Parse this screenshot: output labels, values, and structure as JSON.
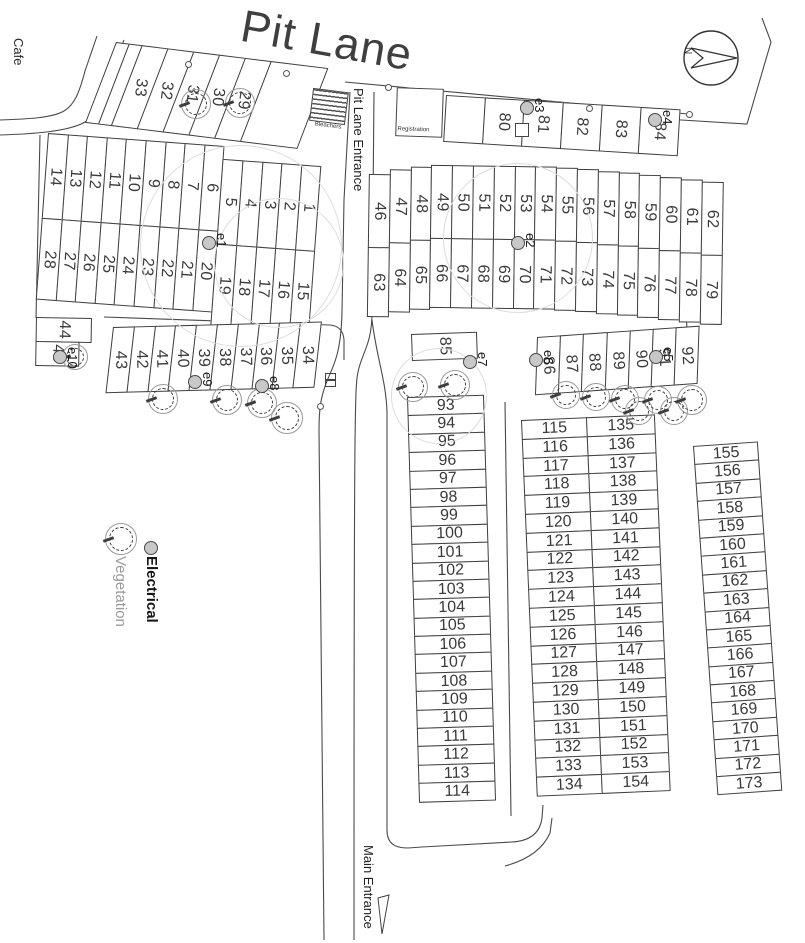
{
  "title": "Pit Lane",
  "compass": {
    "north_label": "N"
  },
  "labels": {
    "cafe": "Cafe",
    "pit_lane_entrance": "Pit Lane Entrance",
    "main_entrance": "Main Entrance",
    "bleachers": "Bleachers",
    "registration": "Registration"
  },
  "legend": {
    "electrical": "Electrical",
    "vegetation": "Vegetation"
  },
  "colors": {
    "line": "#3e3e3e",
    "faint_circle": "#dddddd",
    "electrical_fill": "#c8c8c8",
    "vegetation_stroke": "#9a9a9a",
    "title_text": "#3f3f3f"
  },
  "blocks": {
    "strip_nw": [
      "",
      "",
      "33",
      "32",
      "31",
      "30",
      "29",
      ""
    ],
    "rows_nw": {
      "columns": [
        {
          "t": "14",
          "b": "28"
        },
        {
          "t": "13",
          "b": "27"
        },
        {
          "t": "12",
          "b": "26"
        },
        {
          "t": "11",
          "b": "25"
        },
        {
          "t": "10",
          "b": "24"
        },
        {
          "t": "9",
          "b": "23"
        },
        {
          "t": "8",
          "b": "22"
        },
        {
          "t": "7",
          "b": "21"
        },
        {
          "t": "6",
          "b": "20"
        },
        {
          "t": "5",
          "b": "19",
          "dy": 13
        },
        {
          "t": "4",
          "b": "18",
          "dy": 13
        },
        {
          "t": "3",
          "b": "17",
          "dy": 13
        },
        {
          "t": "2",
          "b": "16",
          "dy": 13
        },
        {
          "t": "1",
          "b": "15",
          "dy": 13
        }
      ]
    },
    "strip_n": [
      "",
      "80",
      "81",
      "82",
      "83",
      "84"
    ],
    "rows_mid": {
      "columns": [
        {
          "t": "46",
          "b": "63",
          "dy": 10
        },
        {
          "t": "47",
          "b": "64",
          "dy": 5
        },
        {
          "t": "48",
          "b": "65",
          "dy": 2
        },
        {
          "t": "49",
          "b": "66"
        },
        {
          "t": "50",
          "b": "67"
        },
        {
          "t": "51",
          "b": "68"
        },
        {
          "t": "52",
          "b": "69"
        },
        {
          "t": "53",
          "b": "70"
        },
        {
          "t": "54",
          "b": "71"
        },
        {
          "t": "55",
          "b": "72",
          "dy": 1
        },
        {
          "t": "56",
          "b": "73",
          "dy": 2
        },
        {
          "t": "57",
          "b": "74",
          "dy": 4
        },
        {
          "t": "58",
          "b": "75",
          "dy": 5
        },
        {
          "t": "59",
          "b": "76",
          "dy": 7
        },
        {
          "t": "60",
          "b": "77",
          "dy": 9
        },
        {
          "t": "61",
          "b": "78",
          "dy": 11
        },
        {
          "t": "62",
          "b": "79",
          "dy": 13
        }
      ]
    },
    "pair_w": [
      "44",
      "45"
    ],
    "row_w": [
      "43",
      "42",
      "41",
      "40",
      "39",
      "38",
      "37",
      "36",
      "35",
      "34"
    ],
    "s85": "85",
    "row_e": [
      "86",
      "87",
      "88",
      "89",
      "90",
      "91",
      "92"
    ],
    "col_a": [
      "93",
      "94",
      "95",
      "96",
      "97",
      "98",
      "99",
      "100",
      "101",
      "102",
      "103",
      "104",
      "105",
      "106",
      "107",
      "108",
      "109",
      "110",
      "111",
      "112",
      "113",
      "114"
    ],
    "col_b": [
      "115",
      "116",
      "117",
      "118",
      "119",
      "120",
      "121",
      "122",
      "123",
      "124",
      "125",
      "126",
      "127",
      "128",
      "129",
      "130",
      "131",
      "132",
      "133",
      "134"
    ],
    "col_c": [
      "135",
      "136",
      "137",
      "138",
      "139",
      "140",
      "141",
      "142",
      "143",
      "144",
      "145",
      "146",
      "147",
      "148",
      "149",
      "150",
      "151",
      "152",
      "153",
      "154"
    ],
    "col_d": [
      "155",
      "156",
      "157",
      "158",
      "159",
      "160",
      "161",
      "162",
      "163",
      "164",
      "165",
      "166",
      "167",
      "168",
      "169",
      "170",
      "171",
      "172",
      "173"
    ]
  },
  "markers": {
    "electrical": [
      {
        "x": 209,
        "y": 243,
        "r": 7,
        "label": "e1"
      },
      {
        "x": 518,
        "y": 243,
        "r": 7,
        "label": "e2"
      },
      {
        "x": 527,
        "y": 108,
        "r": 7,
        "label": "e3"
      },
      {
        "x": 655,
        "y": 120,
        "r": 7,
        "label": "e4"
      },
      {
        "x": 656,
        "y": 357,
        "r": 7,
        "label": "e5"
      },
      {
        "x": 536,
        "y": 360,
        "r": 7,
        "label": "e6"
      },
      {
        "x": 470,
        "y": 362,
        "r": 7,
        "label": "e7"
      },
      {
        "x": 262,
        "y": 386,
        "r": 7,
        "label": "e8"
      },
      {
        "x": 195,
        "y": 382,
        "r": 7,
        "label": "e9"
      },
      {
        "x": 60,
        "y": 357,
        "r": 7,
        "label": "e10"
      }
    ],
    "trees": [
      {
        "x": 196,
        "y": 104,
        "r": 15
      },
      {
        "x": 240,
        "y": 103,
        "r": 15
      },
      {
        "x": 75,
        "y": 357,
        "r": 13
      },
      {
        "x": 163,
        "y": 399,
        "r": 15
      },
      {
        "x": 227,
        "y": 400,
        "r": 15
      },
      {
        "x": 262,
        "y": 403,
        "r": 15
      },
      {
        "x": 287,
        "y": 418,
        "r": 16
      },
      {
        "x": 413,
        "y": 387,
        "r": 15
      },
      {
        "x": 455,
        "y": 385,
        "r": 15
      },
      {
        "x": 566,
        "y": 395,
        "r": 14
      },
      {
        "x": 596,
        "y": 397,
        "r": 14
      },
      {
        "x": 625,
        "y": 399,
        "r": 14
      },
      {
        "x": 639,
        "y": 411,
        "r": 14
      },
      {
        "x": 658,
        "y": 400,
        "r": 14
      },
      {
        "x": 674,
        "y": 411,
        "r": 14
      },
      {
        "x": 692,
        "y": 400,
        "r": 15
      }
    ],
    "faint_circles": [
      {
        "x": 240,
        "y": 245,
        "r": 100
      },
      {
        "x": 278,
        "y": 262,
        "r": 64
      },
      {
        "x": 517,
        "y": 237,
        "r": 74
      },
      {
        "x": 438,
        "y": 395,
        "r": 47
      }
    ],
    "dots": [
      {
        "x": 187,
        "y": 63,
        "r": 2.5
      },
      {
        "x": 285,
        "y": 72,
        "r": 2.5
      },
      {
        "x": 387,
        "y": 86,
        "r": 2.5
      },
      {
        "x": 588,
        "y": 107,
        "r": 2.5
      },
      {
        "x": 688,
        "y": 113,
        "r": 2.5
      },
      {
        "x": 319,
        "y": 405,
        "r": 2.5
      }
    ]
  }
}
